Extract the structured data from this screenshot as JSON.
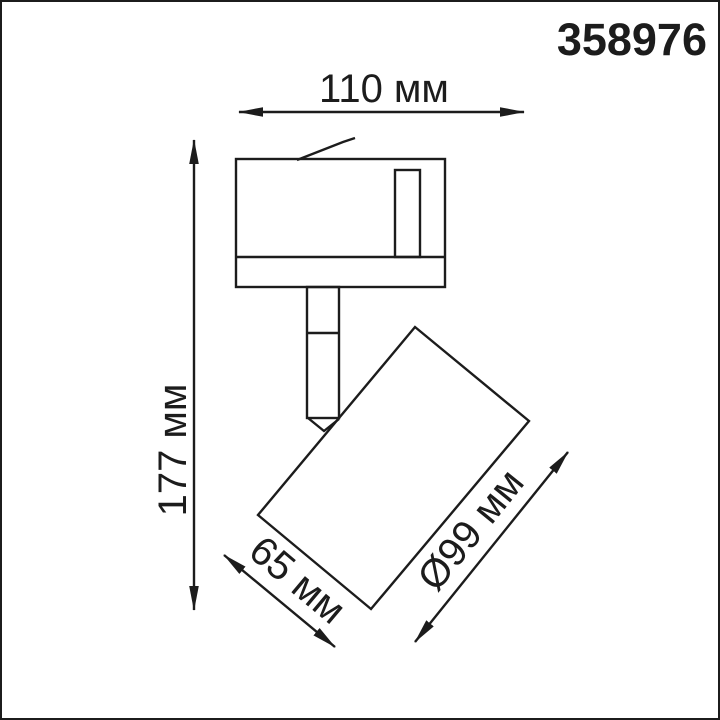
{
  "product_code": "358976",
  "colors": {
    "line": "#1c1c1c",
    "background": "#ffffff"
  },
  "dimensions": {
    "overall_width": {
      "label": "110 мм"
    },
    "overall_height": {
      "label": "177 мм"
    },
    "lamp_length": {
      "label": "65 мм"
    },
    "lamp_diameter": {
      "label": "Ø99 мм"
    }
  }
}
